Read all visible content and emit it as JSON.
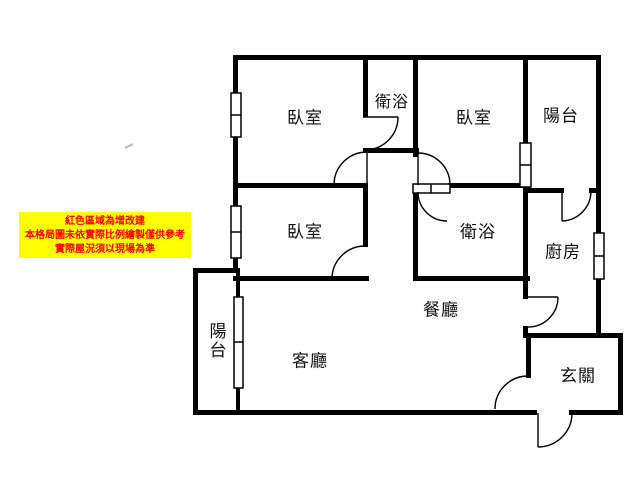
{
  "floor_plan": {
    "rooms": {
      "bedroom_top_left": "臥室",
      "bathroom_top": "衛浴",
      "bedroom_top_right": "臥室",
      "balcony_top_right": "陽台",
      "bedroom_middle_left": "臥室",
      "bathroom_middle": "衛浴",
      "kitchen": "廚房",
      "dining_room": "餐廳",
      "living_room": "客廳",
      "balcony_bottom_left": "陽台",
      "entrance_foyer": "玄關"
    },
    "disclaimer": {
      "bg_color": "#ffff00",
      "text_color": "#ff0000",
      "lines": [
        "紅色區域為增改建",
        "本格局圖未依實際比例繪製僅供參考",
        "實際屋況須以現場為準"
      ]
    },
    "wall_color": "#000000",
    "background_color": "#ffffff"
  }
}
